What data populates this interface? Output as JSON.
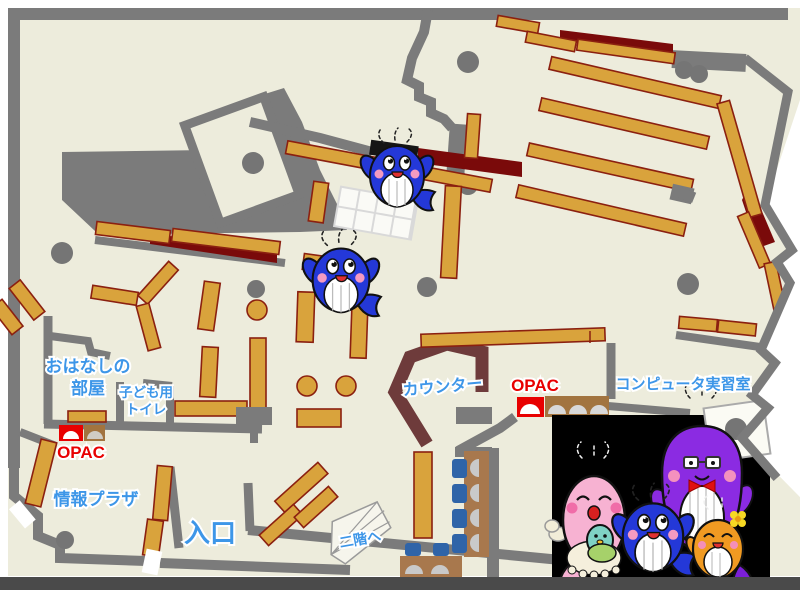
{
  "labels": {
    "storytelling_room_1": "おはなしの",
    "storytelling_room_2": "部屋",
    "kids_toilet_1": "子ども用",
    "kids_toilet_2": "トイレ",
    "opac_left": "OPAC",
    "opac_right": "OPAC",
    "info_plaza": "情報プラザ",
    "entrance": "入口",
    "counter": "カウンター",
    "to_second_floor": "二階へ",
    "computer_room": "コンピュータ実習室"
  },
  "colors": {
    "floor": "#edecdc",
    "wall": "#7b7b7b",
    "shelf": "#d9a33c",
    "shelf_border": "#8b2010",
    "counter": "#6e3b3b",
    "accent_maroon": "#7a0a0a",
    "label_blue": "#3d96e8",
    "label_red": "#e80000",
    "chair_blue": "#2f64a8",
    "desk_brown": "#a8784d",
    "panel_black": "#000000"
  },
  "icons": {
    "floor_whale": "blue-whale-mascot",
    "family": [
      "papa-whale-purple",
      "mama-whale-pink",
      "baby-whale-teal",
      "kid-whale-blue",
      "kid-whale-orange"
    ]
  }
}
